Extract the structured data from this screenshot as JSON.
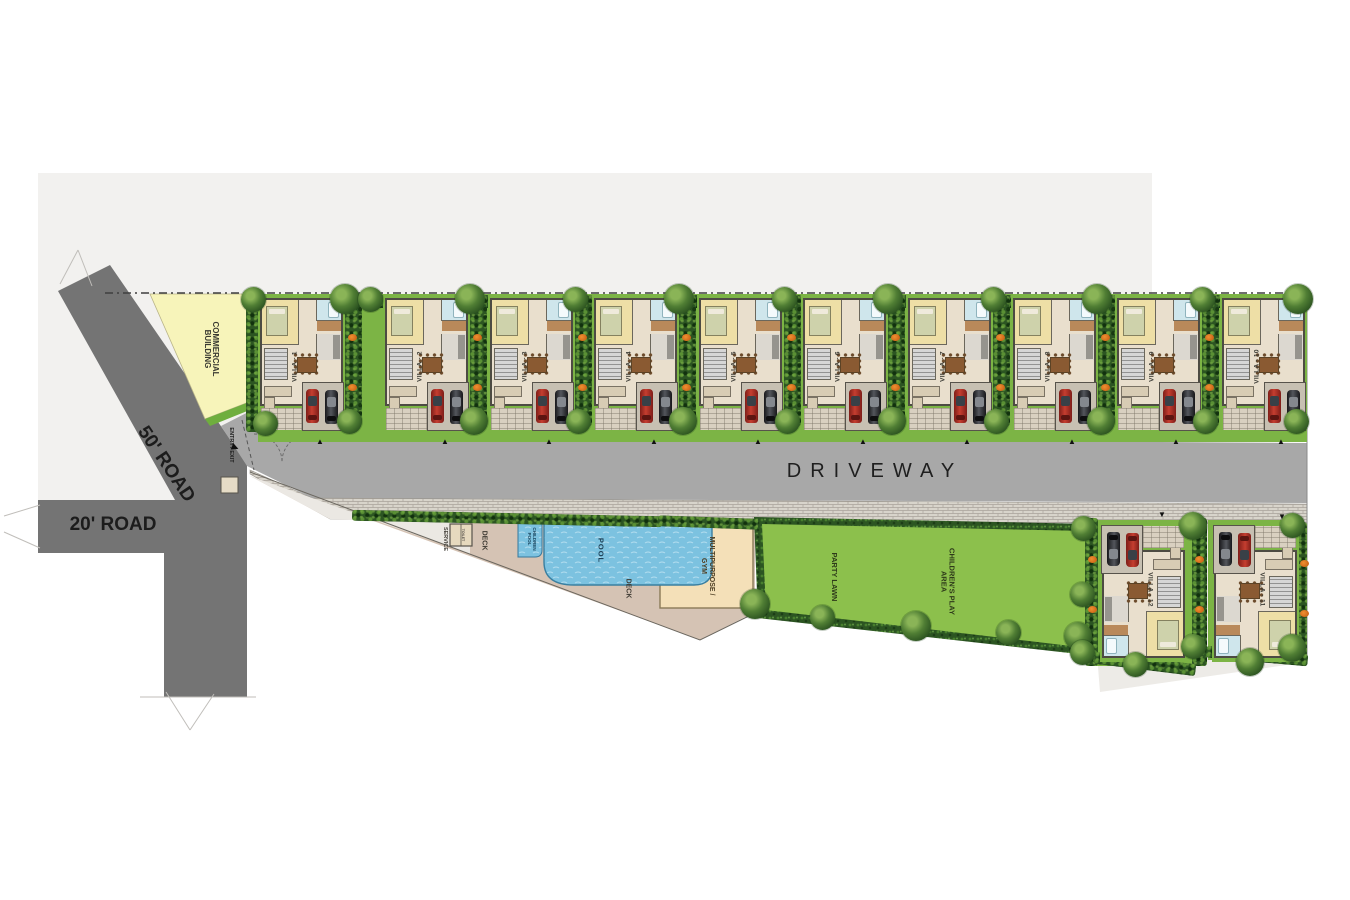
{
  "roads": {
    "fifty": "50' ROAD",
    "twenty": "20' ROAD",
    "driveway": "DRIVEWAY",
    "entry_exit": "ENTRY / EXIT"
  },
  "areas": {
    "commercial_line1": "COMMERCIAL",
    "commercial_line2": "BUILDING",
    "service": "SERVICE",
    "toilet": "TOILET",
    "deck_upper": "DECK",
    "deck_lower": "DECK",
    "children_pool_line1": "CHILDREN",
    "children_pool_line2": "POOL",
    "pool": "POOL",
    "gym_line1": "MULTIPURPOSE /",
    "gym_line2": "GYM",
    "party_lawn": "PARTY LAWN",
    "play_line1": "CHILDREN'S PLAY",
    "play_line2": "AREA"
  },
  "villas_top": [
    {
      "label": "VILLA - 1"
    },
    {
      "label": "VILLA - 2"
    },
    {
      "label": "VILLA - 3"
    },
    {
      "label": "VILLA - 4"
    },
    {
      "label": "VILLA - 5"
    },
    {
      "label": "VILLA - 6"
    },
    {
      "label": "VILLA - 7"
    },
    {
      "label": "VILLA - 8"
    },
    {
      "label": "VILLA - 9"
    },
    {
      "label": "VILLA - 10"
    }
  ],
  "villas_bottom": [
    {
      "label": "VILLA - 12"
    },
    {
      "label": "VILLA - 11"
    }
  ],
  "colors": {
    "backdrop": "#f2f1ef",
    "road": "#747474",
    "driveway": "#a8a8a8",
    "paver": "#d8d4cb",
    "lawn": "#7cb445",
    "lawn_bright": "#8cc04c",
    "hedge": "#2c5522",
    "commercial_yellow": "#f7f4ba",
    "deck_tan": "#d5c3b4",
    "gym_beige": "#f4e0b8",
    "pool_blue": "#7cc2e0",
    "villa_floor": "#e9dfcd",
    "car_red": "#b5332b"
  }
}
